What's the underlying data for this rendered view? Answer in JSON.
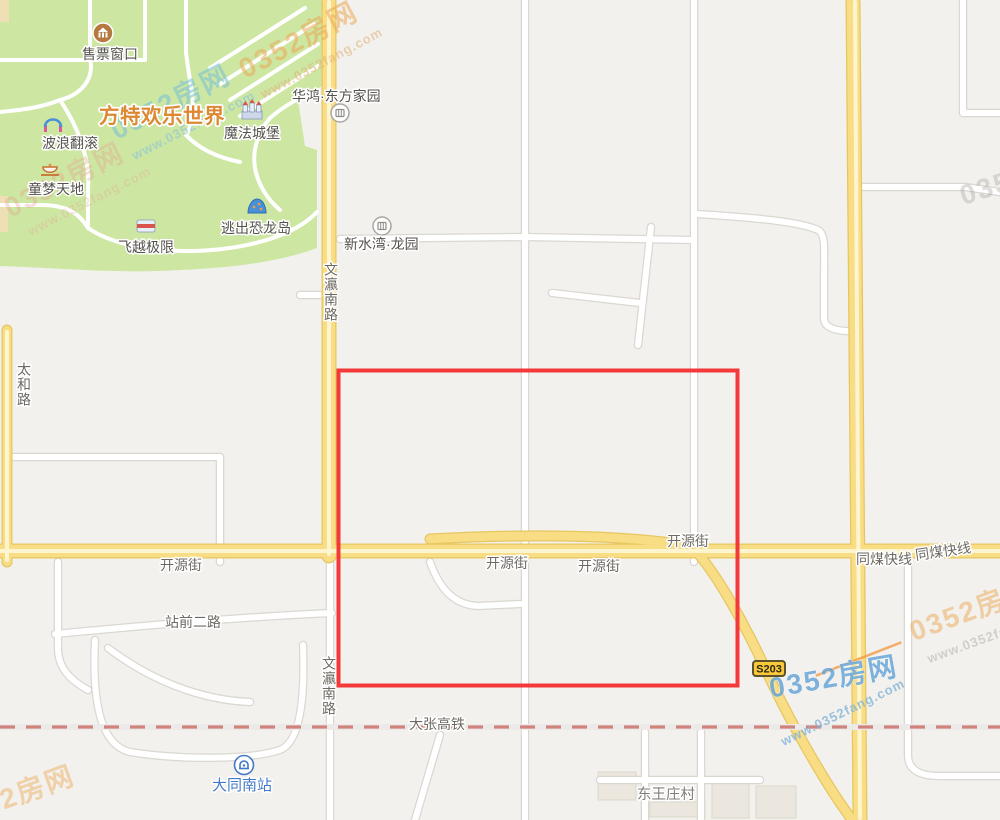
{
  "watermark": {
    "brand": "0352房网",
    "url": "www.0352fang.com"
  },
  "park": {
    "title": "方特欢乐世界",
    "features": {
      "ticket": "售票窗口",
      "wave": "波浪翻滚",
      "castle": "魔法城堡",
      "kids": "童梦天地",
      "dino": "逃出恐龙岛",
      "flight": "飞越极限"
    }
  },
  "pois": {
    "huahong": "华鸿·东方家园",
    "xinshuiwan": "新水湾·龙园",
    "station": "大同南站",
    "village": "东王庄村"
  },
  "roads": {
    "wenying": "文瀛南路",
    "taihe": "太和路",
    "kaiyuan": "开源街",
    "tongmei": "同煤快线",
    "zhanqian": "站前二路",
    "railway": "大张高铁",
    "badge": "S203"
  },
  "colors": {
    "park_green": "#cde7a3",
    "road_yellow": "#f8dd85",
    "highlight_red": "#f4393b",
    "railway_pink": "#d0827c",
    "station_blue": "#4279c8",
    "park_title_orange": "#dd8833"
  }
}
